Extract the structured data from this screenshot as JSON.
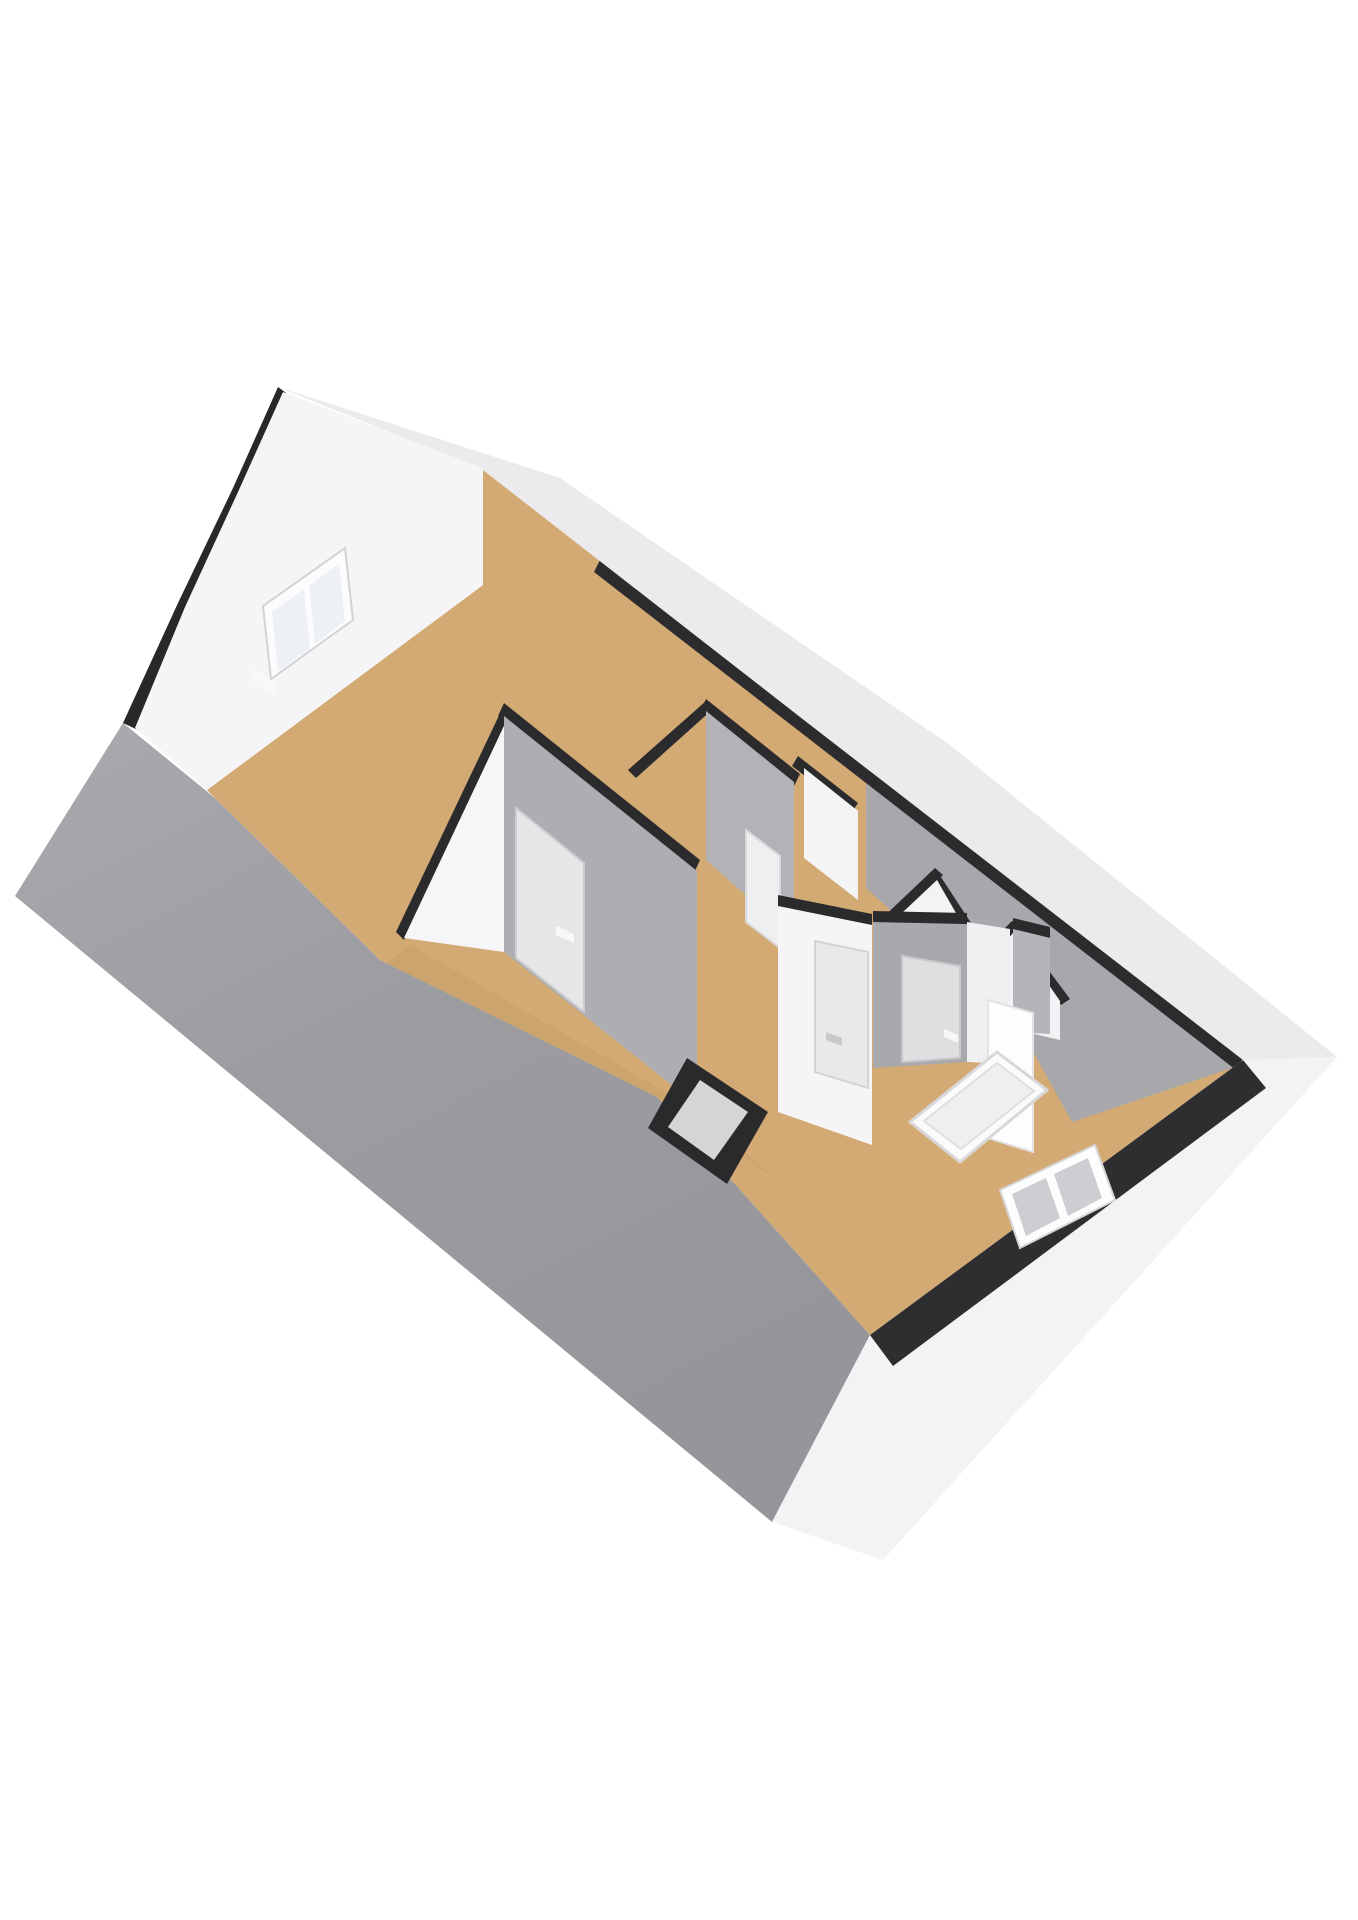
{
  "meta": {
    "kind": "3d-floorplan-render",
    "description": "Isometric 3D floor plan of an attic storey, viewed from above; near roof slope shown as grey plane, far roof cut away, tan wooden floors, white and grey walls with black cut caps, gable window top-left, knee-wall window bottom-right, stair opening with white railing, small black chimney shaft"
  },
  "palette": {
    "background": "#ffffff",
    "roof_grey_light": "#a9a9ad",
    "roof_grey_dark": "#96969a",
    "floor_tan": "#d3aa73",
    "floor_tan_shade": "#c59f69",
    "wall_white": "#f5f5f7",
    "wall_grey": "#aeaeb2",
    "cap_black": "#2b2b2e",
    "band_white": "#ebebee",
    "pane_grey": "#ccced2",
    "pane_light": "#eef1f4",
    "frame_white": "#fdfdfe"
  },
  "scene": {
    "viewBox": "0 0 1358 1920",
    "shapes": [
      {
        "name": "attic-floor",
        "fill": "#d3aa73",
        "points": "207,790 483,585 483,470 1243,1060 870,1335 657,1097 380,960 215,798"
      },
      {
        "name": "far-roof-inner-slope",
        "fill": "#a8a8ac",
        "points": "866,780 1238,1066 1072,1122 1020,1028 866,888"
      },
      {
        "name": "ne-eave-black-band",
        "fill": "#2c2c2f",
        "points": "600,560 1243,1058 1236,1070 594,572"
      },
      {
        "name": "partition-wall-b-cap",
        "fill": "#2b2b2e",
        "points": "504,705 511,711 404,940 396,932"
      },
      {
        "name": "partition-wall-b-face",
        "fill": "#f6f6f8",
        "points": "511,711 511,953 404,938"
      },
      {
        "name": "central-wall-cap",
        "fill": "#2b2b2e",
        "points": "504,703 700,860 694,873 498,716"
      },
      {
        "name": "central-wall-face",
        "fill": "#aeaeb2",
        "points": "504,716 697,871 697,1105 504,952"
      },
      {
        "name": "central-wall-door",
        "fill": "#e6e6e9",
        "stroke": "#cdcdd0",
        "strokeWidth": 2,
        "points": "516,808 584,863 584,1012 516,958"
      },
      {
        "name": "central-wall-door-handle",
        "fill": "#f8f8fa",
        "points": "556,926 574,934 574,943 556,935"
      },
      {
        "name": "small-room-wall-cap-left",
        "fill": "#2b2b2e",
        "points": "628,770 706,701 714,708 636,778"
      },
      {
        "name": "small-room-wall-cap-top",
        "fill": "#2b2b2e",
        "points": "706,699 800,774 794,786 700,711"
      },
      {
        "name": "small-room-wall-face",
        "fill": "#b3b3b7",
        "points": "706,711 794,782 794,938 706,860"
      },
      {
        "name": "small-room-door",
        "fill": "#efeff1",
        "stroke": "#d9d9db",
        "strokeWidth": 2,
        "points": "746,830 780,856 780,948 746,922"
      },
      {
        "name": "dormer-cheek-cap",
        "fill": "#2b2b2e",
        "points": "798,756 858,803 852,812 792,766"
      },
      {
        "name": "dormer-cheek-face",
        "fill": "#f4f4f6",
        "points": "804,768 858,811 858,900 804,858"
      },
      {
        "name": "mid-room-gable-cap-left",
        "fill": "#2b2b2e",
        "points": "878,922 935,868 943,875 886,930"
      },
      {
        "name": "mid-room-gable-cap-right",
        "fill": "#2b2b2e",
        "points": "935,868 992,955 983,961 927,876"
      },
      {
        "name": "mid-room-gable-face",
        "fill": "#f3f3f5",
        "points": "886,928 937,880 983,960 983,1004 886,966"
      },
      {
        "name": "east-room-gable-cap-left",
        "fill": "#2b2b2e",
        "points": "962,975 1012,921 1020,928 970,983"
      },
      {
        "name": "east-room-gable-cap-right",
        "fill": "#2b2b2e",
        "points": "1012,921 1070,999 1061,1005 1004,929"
      },
      {
        "name": "east-room-gable-face",
        "fill": "#f2f2f4",
        "points": "970,981 1013,933 1060,1001 1060,1040 970,1019"
      },
      {
        "name": "bottom-room-wall-cap",
        "fill": "#2b2b2e",
        "points": "778,895 872,914 872,927 778,908"
      },
      {
        "name": "bottom-room-wall-face",
        "fill": "#f5f5f7",
        "points": "778,906 872,925 872,1145 778,1112"
      },
      {
        "name": "bottom-room-door-left",
        "fill": "#e9e9eb",
        "stroke": "#d4d4d6",
        "strokeWidth": 2,
        "points": "815,941 868,952 868,1088 815,1072"
      },
      {
        "name": "bottom-room-door-left-handle",
        "fill": "#c9c9cc",
        "points": "826,1032 842,1038 842,1046 826,1040"
      },
      {
        "name": "bottom-room-wall2-cap",
        "fill": "#2b2b2e",
        "points": "873,911 967,913 967,926 873,924"
      },
      {
        "name": "bottom-room-wall2-face",
        "fill": "#a9a9ad",
        "points": "873,922 967,924 967,1062 873,1068"
      },
      {
        "name": "bottom-room-door-right",
        "fill": "#dfdfe2",
        "stroke": "#c8c8cb",
        "strokeWidth": 2,
        "points": "902,956 960,966 960,1058 902,1062"
      },
      {
        "name": "bottom-room-door-right-handle",
        "fill": "#f6f6f8",
        "points": "944,1029 958,1035 958,1043 944,1037"
      },
      {
        "name": "stairwell-wall",
        "fill": "#eff0f2",
        "points": "967,922 1010,929 1010,1064 967,1062"
      },
      {
        "name": "east-wall-cap",
        "fill": "#2b2b2e",
        "points": "1013,918 1050,927 1050,938 1013,929"
      },
      {
        "name": "east-wall-face",
        "fill": "#b5b5b9",
        "points": "1013,929 1050,938 1050,1034 1013,1032"
      },
      {
        "name": "stairwell-column",
        "fill": "#fdfdfe",
        "stroke": "#e3e3e6",
        "strokeWidth": 2,
        "points": "988,1000 1033,1013 1033,1152 988,1138"
      },
      {
        "name": "hallway-floor-shade",
        "fill": "#c59f69",
        "opacity": 0.55,
        "points": "410,945 697,1110 775,1178 655,1098 385,965"
      },
      {
        "name": "stair-railing-frame",
        "fill": "#fbfbfc",
        "stroke": "#d8d8db",
        "strokeWidth": 3,
        "points": "910,1122 997,1052 1047,1090 960,1162"
      },
      {
        "name": "stair-railing-panel",
        "fill": "#edeff1",
        "stroke": "#dfdfe2",
        "strokeWidth": 2,
        "points": "924,1121 997,1063 1034,1091 961,1149"
      },
      {
        "name": "near-roof-plane",
        "fill": "url(#roofGradient)",
        "points": "123,723 215,798 380,960 657,1097 870,1335 772,1522 15,896"
      },
      {
        "name": "chimney-shaft-outer",
        "fill": "#2a2a2d",
        "points": "687,1058 768,1112 727,1184 648,1128"
      },
      {
        "name": "chimney-shaft-inner",
        "fill": "#d5d5d8",
        "points": "700,1080 748,1112 714,1160 668,1127"
      },
      {
        "name": "se-exterior-wall",
        "fill": "#f3f3f5",
        "points": "1243,1060 1337,1057 883,1560 772,1522 870,1335"
      },
      {
        "name": "se-kneewall-black-band",
        "fill": "#2e2e31",
        "points": "1243,1060 870,1335 893,1366 1266,1088"
      },
      {
        "name": "se-window-frame",
        "fill": "#fdfdfe",
        "stroke": "#d6d6d9",
        "strokeWidth": 2,
        "points": "1000,1190 1095,1145 1115,1200 1020,1248"
      },
      {
        "name": "se-window-pane-left",
        "fill": "#ccced2",
        "points": "1012,1194 1046,1178 1060,1218 1026,1236"
      },
      {
        "name": "se-window-pane-right",
        "fill": "#ccced2",
        "points": "1054,1174 1088,1158 1102,1198 1068,1216"
      },
      {
        "name": "ne-roof-edge-band",
        "fill": "#ebebee",
        "points": "278,387 560,478 950,745 1337,1057 1243,1060 800,717 483,470"
      },
      {
        "name": "gable-verge-trim",
        "fill": "#28282b",
        "points": "278,387 297,401 252,489 198,607 140,731 123,723 178,603 233,488"
      },
      {
        "name": "gable-end-wall",
        "fill": "#f5f5f7",
        "points": "283,392 483,468 483,585 207,790 135,728 185,607 238,492"
      },
      {
        "name": "gable-window-frame",
        "fill": "#fcfcfe",
        "stroke": "#d3d3d6",
        "strokeWidth": 2,
        "points": "263,606 345,548 353,620 271,679"
      },
      {
        "name": "gable-window-pane-left",
        "fill": "#eef1f4",
        "points": "272,612 304,589 310,649 278,671"
      },
      {
        "name": "gable-window-pane-right",
        "fill": "#eef1f4",
        "points": "309,586 339,564 345,621 315,644"
      },
      {
        "name": "gable-window-sill",
        "fill": "#f8f8fa",
        "points": "254,668 277,684 273,697 250,680"
      }
    ]
  }
}
